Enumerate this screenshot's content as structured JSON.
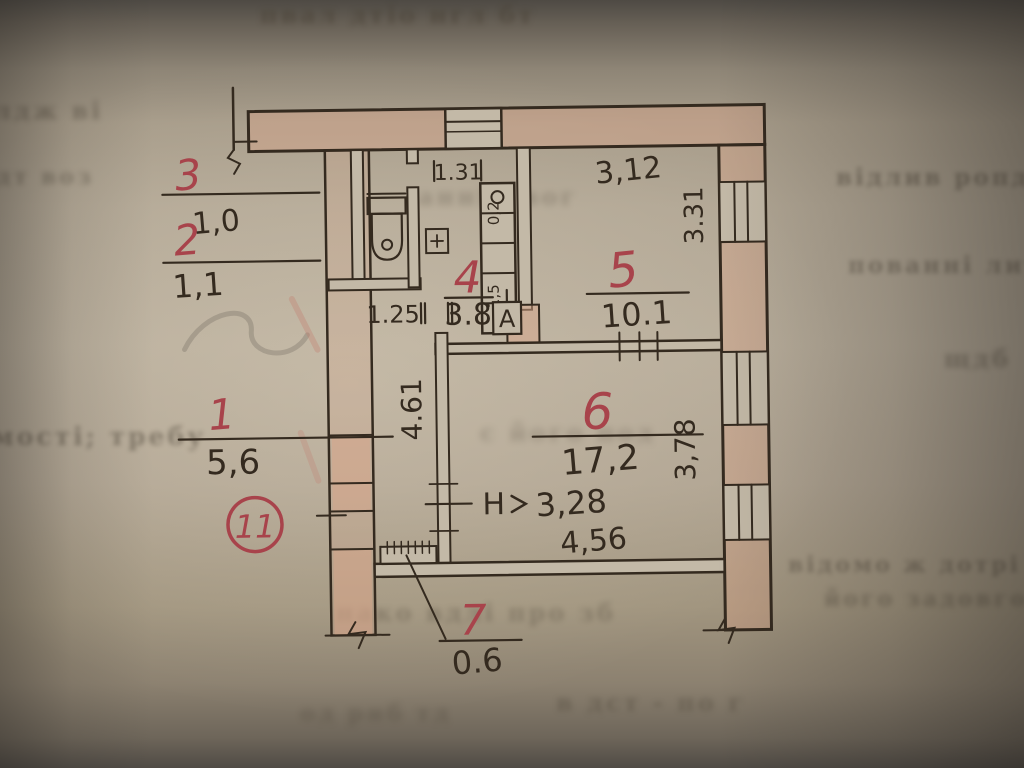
{
  "plan": {
    "sheet_mark": "11",
    "axis_marker": "А",
    "rooms": [
      {
        "id": "1",
        "area": "5,6"
      },
      {
        "id": "2",
        "area": "1,1"
      },
      {
        "id": "3",
        "area": "1,0"
      },
      {
        "id": "4",
        "area": "3.8"
      },
      {
        "id": "5",
        "area": "10.1"
      },
      {
        "id": "6",
        "area": "17,2"
      },
      {
        "id": "7",
        "area": "0.6"
      }
    ],
    "dimensions": {
      "hall_top_width": "1.31",
      "room5_width": "3,12",
      "room5_depth": "3.31",
      "hall_width": "1.25",
      "room6_side": "4.61",
      "room6_bottom": "4,56",
      "room6_depth": "3,78",
      "height_prefix": "Н",
      "height_value": "3,28",
      "duct_a": "0,2",
      "duct_b": "1,5"
    },
    "bleed_text": [
      "пвал дтіо нгл бт",
      "відлив ропдв",
      "пованні литво",
      "лдж ві",
      "щдб",
      "анніч вог",
      "мості; требу",
      "с його под",
      "відомо ж дотрі",
      "його задовго в",
      "нако вдлі про зб",
      "в дст - по г",
      "дт воз",
      "од рнб тд"
    ]
  }
}
